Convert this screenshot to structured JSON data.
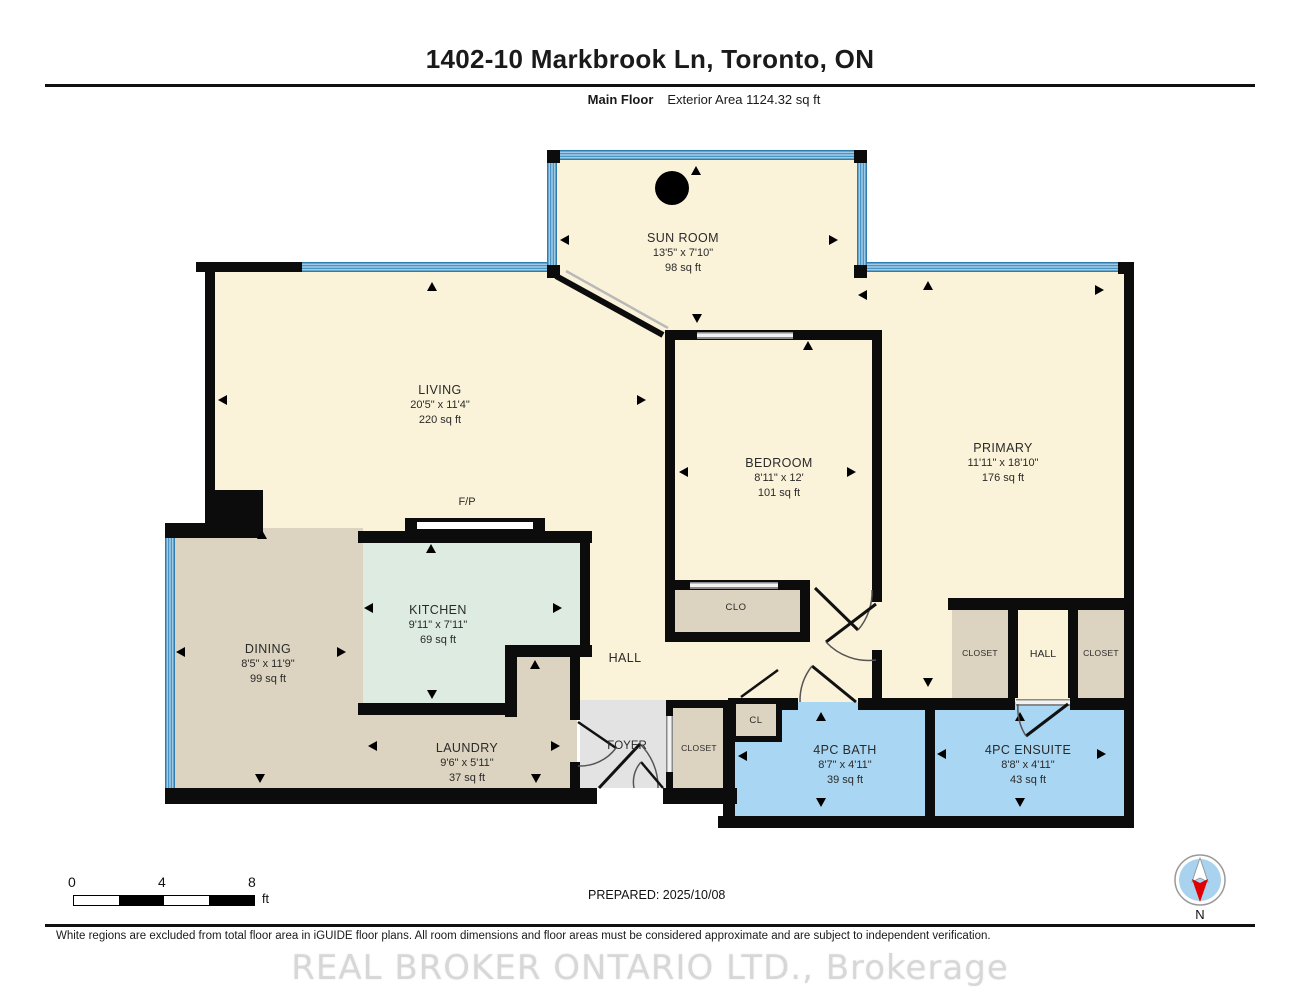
{
  "header": {
    "title": "1402-10 Markbrook Ln, Toronto, ON",
    "floor_label": "Main Floor",
    "exterior_area": "Exterior Area 1124.32 sq ft"
  },
  "rooms": {
    "sun_room": {
      "name": "SUN ROOM",
      "dims": "13'5\" x 7'10\"",
      "area": "98 sq ft"
    },
    "living": {
      "name": "LIVING",
      "dims": "20'5\" x 11'4\"",
      "area": "220 sq ft"
    },
    "primary": {
      "name": "PRIMARY",
      "dims": "11'11\" x 18'10\"",
      "area": "176 sq ft"
    },
    "bedroom": {
      "name": "BEDROOM",
      "dims": "8'11\" x 12'",
      "area": "101 sq ft"
    },
    "dining": {
      "name": "DINING",
      "dims": "8'5\" x 11'9\"",
      "area": "99 sq ft"
    },
    "kitchen": {
      "name": "KITCHEN",
      "dims": "9'11\" x 7'11\"",
      "area": "69 sq ft"
    },
    "laundry": {
      "name": "LAUNDRY",
      "dims": "9'6\" x 5'11\"",
      "area": "37 sq ft"
    },
    "bath": {
      "name": "4PC BATH",
      "dims": "8'7\" x 4'11\"",
      "area": "39 sq ft"
    },
    "ensuite": {
      "name": "4PC ENSUITE",
      "dims": "8'8\" x 4'11\"",
      "area": "43 sq ft"
    },
    "hall_main": {
      "name": "HALL"
    },
    "hall_right": {
      "name": "HALL"
    },
    "foyer": {
      "name": "FOYER"
    },
    "clo": {
      "name": "CLO"
    },
    "cl": {
      "name": "CL"
    },
    "closet_foyer": {
      "name": "CLOSET"
    },
    "closet_right_1": {
      "name": "CLOSET"
    },
    "closet_right_2": {
      "name": "CLOSET"
    },
    "fireplace": {
      "name": "F/P"
    }
  },
  "scale_bar": {
    "tick_0": "0",
    "tick_4": "4",
    "tick_8": "8",
    "unit": "ft"
  },
  "footer": {
    "prepared": "PREPARED: 2025/10/08",
    "compass_label": "N",
    "disclaimer": "White regions are excluded from total floor area in iGUIDE floor plans. All room dimensions and floor areas must be considered approximate and are subject to independent verification.",
    "watermark": "REAL BROKER ONTARIO LTD., Brokerage"
  },
  "colors": {
    "room_cream": "#FBF3D9",
    "room_tan": "#DCD3C0",
    "kitchen_mint": "#DDEBE1",
    "bath_blue": "#A9D6F2",
    "foyer_gray": "#E3E3E3",
    "window_blue": "#4A94C6",
    "wall_black": "#0C0C0C",
    "compass_blue": "#A8D2EE",
    "compass_red": "#E00000"
  }
}
